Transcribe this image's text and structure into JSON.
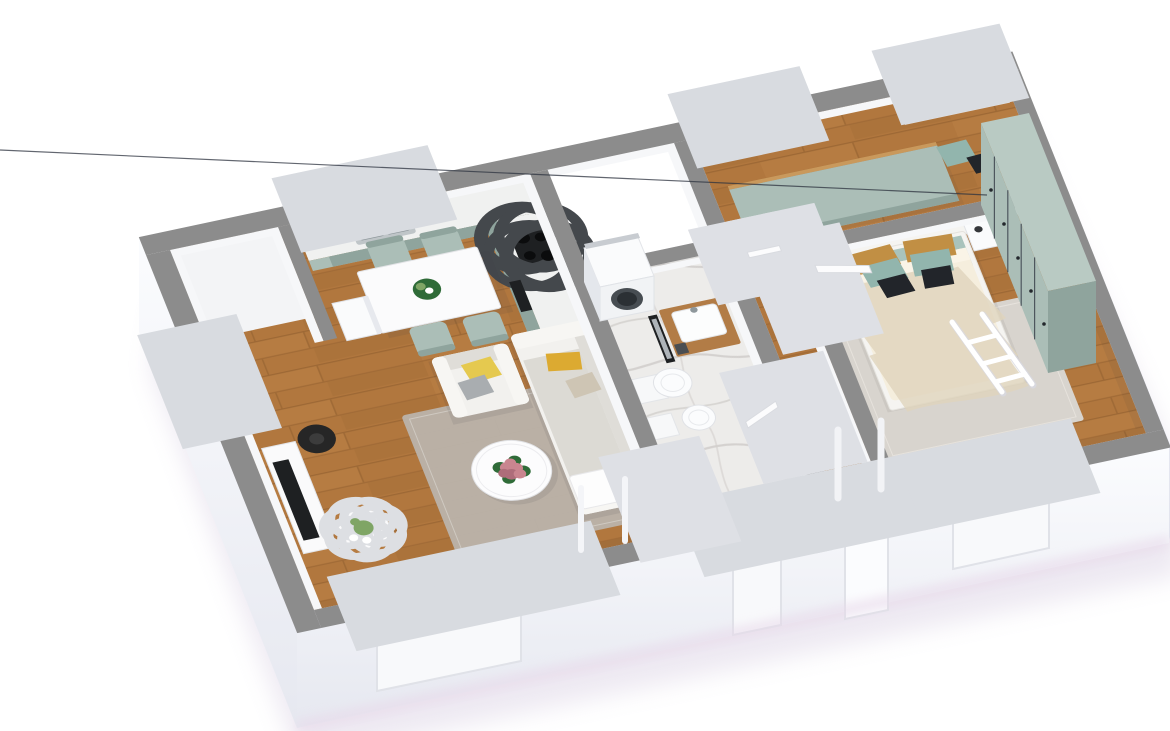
{
  "scene": {
    "type": "isometric-3d-floor-plan-render",
    "description": "3D cutaway floor plan of a two-room apartment viewed from above at an angle",
    "background": "#ffffff",
    "rooms": [
      {
        "name": "living-room",
        "floor": "wood",
        "furniture": [
          "sofa",
          "armchair",
          "round-coffee-table",
          "flower-centerpiece",
          "area-rug",
          "tv-console",
          "tv",
          "floor-lamp",
          "cactus-planter"
        ]
      },
      {
        "name": "kitchen-dining",
        "floor": "wood",
        "furniture": [
          "l-shaped-sage-counter",
          "steel-sink",
          "black-cooktop",
          "oven",
          "dining-table",
          "dining-chairs",
          "table-plant"
        ]
      },
      {
        "name": "entry-nook",
        "floor": "white",
        "furniture": [
          "white-cabinet"
        ]
      },
      {
        "name": "bathroom",
        "floor": "marble",
        "furniture": [
          "washing-machine",
          "wood-vanity-with-basin",
          "leaning-mirror",
          "wall-hung-toilet",
          "bidet"
        ]
      },
      {
        "name": "hallway",
        "floor": "wood",
        "furniture": [
          "runner-rug"
        ]
      },
      {
        "name": "bedroom",
        "floor": "wood",
        "furniture": [
          "double-bed",
          "headboard",
          "pillows",
          "nightstand-left",
          "nightstand-right",
          "sage-wardrobe",
          "area-rug",
          "white-drying-rack"
        ]
      },
      {
        "name": "second-room",
        "floor": "wood",
        "furniture": [
          "sage-daybed",
          "white-wall-shelf",
          "floor-cushions",
          "small-plant",
          "picture-frame"
        ]
      }
    ],
    "openings": [
      "living-window",
      "bathroom-window",
      "entrance-opening",
      "bedroom-window",
      "kitchen-window",
      "second-room-windows"
    ]
  },
  "colors": {
    "background": "#ffffff",
    "wood": "#b1773e",
    "woodDark": "#8a5a2c",
    "woodLight": "#cf9455",
    "marble": "#edecea",
    "marbleVein": "#d2cfcc",
    "wallTop": "#8c8c8c",
    "wallFace": "#f6f7f9",
    "wallFaceShade": "#e7e9ee",
    "floorWhite": "#f3f4f6",
    "sage": "#abbeb7",
    "sageDark": "#8fa49d",
    "sageTop": "#b9cac3",
    "counter": "#f0f1f0",
    "steel": "#bfc5c8",
    "steelDark": "#8e979b",
    "black": "#1e2022",
    "sofa": "#f2f1ee",
    "sofaShade": "#dfddd8",
    "bedFrame": "#f5f4f1",
    "mattressTeal": "#a9c3bc",
    "rugLiving": "#bab3ab",
    "rugBedroom": "#d8d4ce",
    "rugHall": "#c6c2bc",
    "duvet": "#f5eedd",
    "duvetShade": "#e0d5bd",
    "pillowYellow": "#e5c94f",
    "pillowMustard": "#dcaa31",
    "pillowGray": "#a9adb0",
    "pillowBeige": "#cec5b4",
    "pillowTeal": "#92b5ad",
    "pillowBlack": "#22252a",
    "pillowTan": "#c18f44",
    "vanityWood": "#b27c46",
    "flower": "#c9858f",
    "flowerDark": "#ae6d7a",
    "leaf": "#2f6b38",
    "cactus": "#7fa565",
    "lamp": "#262626",
    "door": "#fcfcfd",
    "frame": "#e0e2e8",
    "shadow": "#d8cfe2",
    "outerFace": "#f8f9fb",
    "outerFaceShade": "#e6e8f0"
  }
}
